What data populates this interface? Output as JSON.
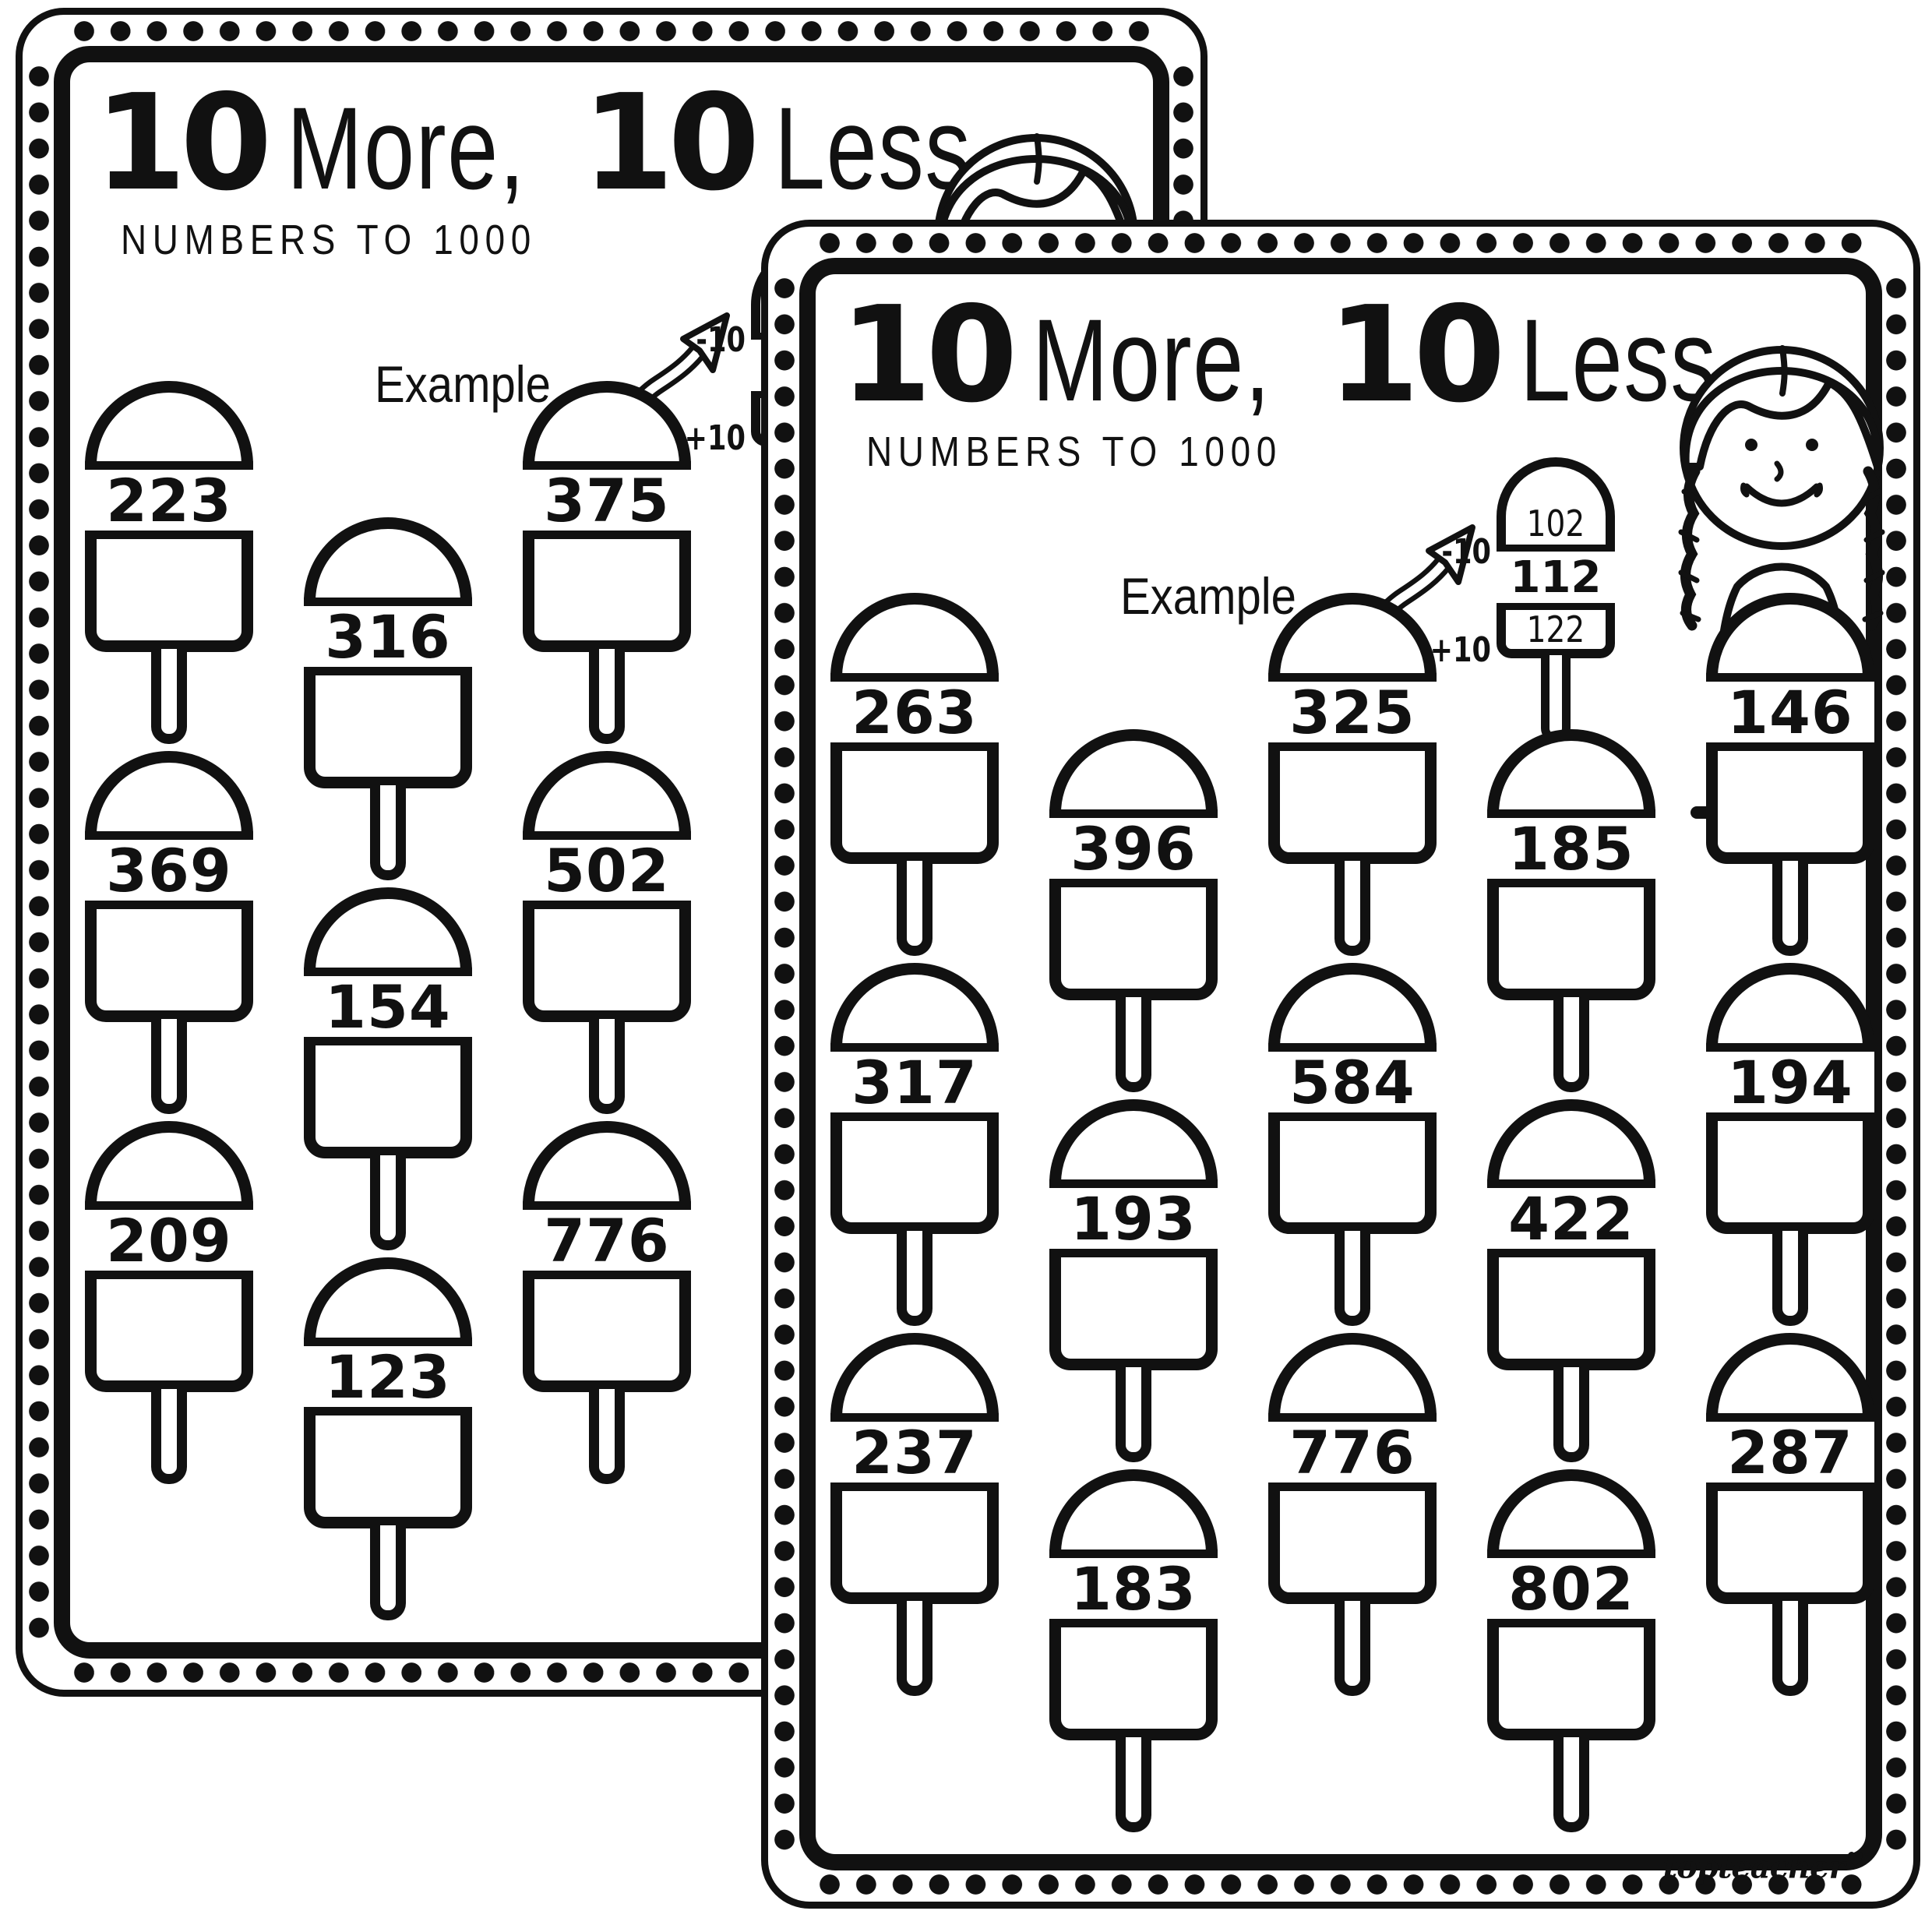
{
  "header": {
    "bold_num": "10",
    "word_more": "More,",
    "word_less": "Less.",
    "subtitle": "NUMBERS TO 1000"
  },
  "example": {
    "label": "Example",
    "minus": "-10",
    "plus": "+10",
    "ten_less": "102",
    "number": "112",
    "ten_more": "122"
  },
  "front_page": {
    "columns": [
      {
        "numbers": [
          "263",
          "317",
          "237"
        ]
      },
      {
        "numbers": [
          "396",
          "193",
          "183"
        ]
      },
      {
        "numbers": [
          "325",
          "584",
          "776"
        ]
      },
      {
        "numbers": [
          "185",
          "422",
          "802"
        ]
      },
      {
        "numbers": [
          "146",
          "194",
          "287"
        ]
      }
    ]
  },
  "back_page": {
    "columns": [
      {
        "numbers": [
          "223",
          "369",
          "209"
        ]
      },
      {
        "numbers": [
          "316",
          "154",
          "123"
        ]
      },
      {
        "numbers": [
          "375",
          "502",
          "776"
        ]
      }
    ]
  },
  "brand": {
    "name": "topteacher",
    "heart": "♥"
  },
  "icons": {
    "girl": "girl-with-braids-eating-ice-cream",
    "arrow": "curly-arrow",
    "popsicle": "popsicle-outline"
  },
  "colors": {
    "ink": "#111111",
    "paper": "#ffffff"
  }
}
